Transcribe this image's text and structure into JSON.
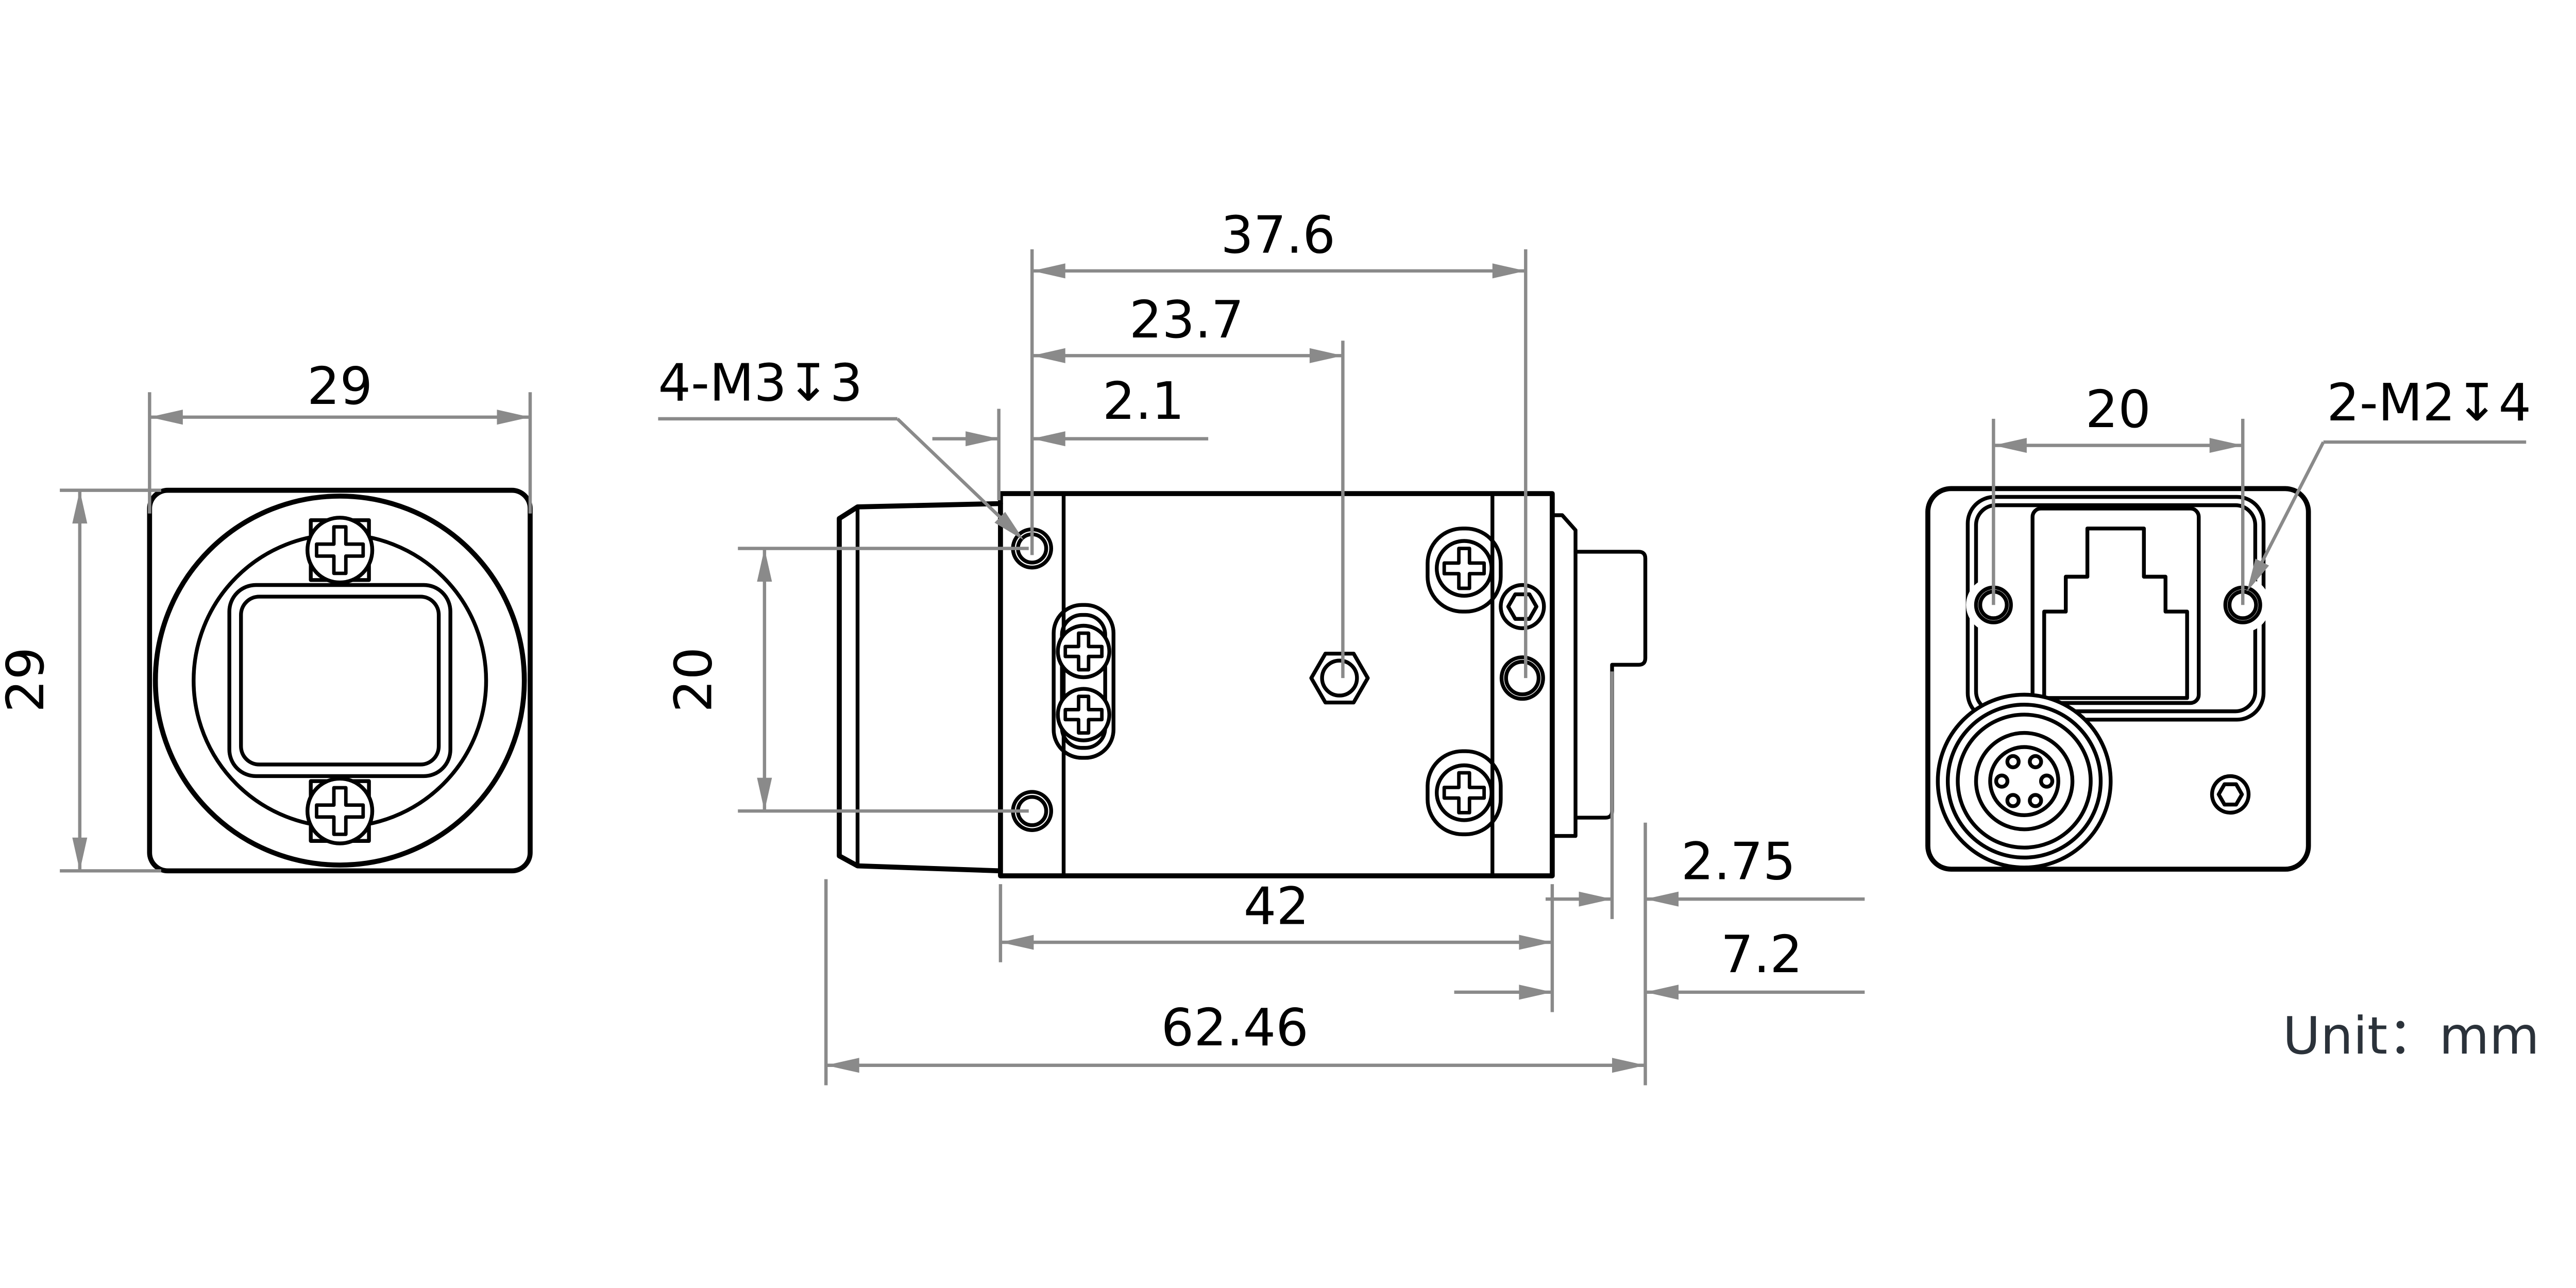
{
  "drawing": {
    "type": "mechanical-dimension-drawing",
    "subject": "industrial box camera, three orthographic views",
    "unit_label": "Unit：mm",
    "front_view": {
      "width_dim": "29",
      "height_dim": "29"
    },
    "side_view": {
      "thread_note": "4-M3↧3",
      "dim_top_overall": "37.6",
      "dim_top_mid": "23.7",
      "dim_top_small": "2.1",
      "dim_hole_pitch": "20",
      "dim_body_length": "42",
      "dim_overall_length": "62.46",
      "dim_step": "2.75",
      "dim_connector_protrusion": "7.2"
    },
    "rear_view": {
      "dim_hole_pitch": "20",
      "thread_note": "2-M2↧4"
    },
    "dimensions_mm": [
      29,
      29,
      37.6,
      23.7,
      2.1,
      20,
      42,
      62.46,
      2.75,
      7.2,
      20
    ],
    "colors": {
      "part_line": "#000000",
      "dimension_line": "#8a8a8a",
      "unit_text": "#2b323a",
      "background": "#ffffff"
    }
  }
}
